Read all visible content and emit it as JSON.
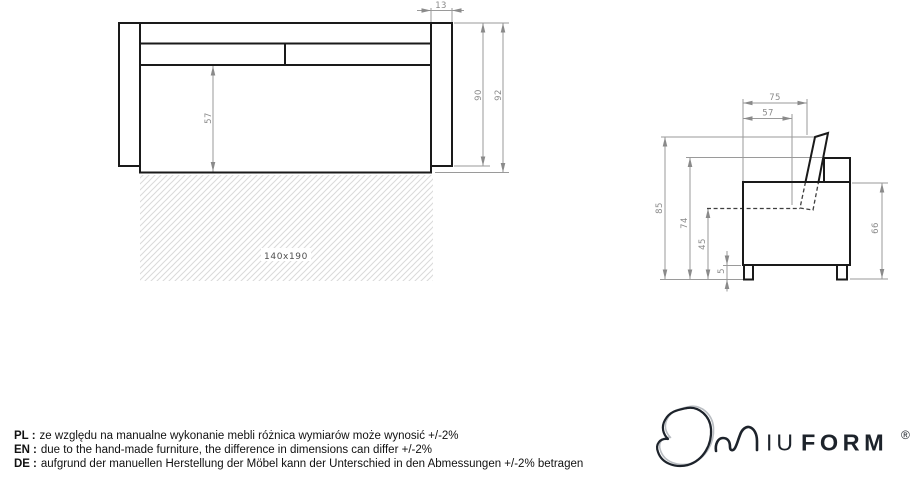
{
  "front_view": {
    "dims": {
      "armrest_width": "13",
      "body_height": "90",
      "total_height": "92",
      "seat_front_height": "57"
    },
    "mattress_label": "140x190"
  },
  "side_view": {
    "dims": {
      "top_depth": "75",
      "seat_depth": "57",
      "cushion_top_height": "85",
      "backrest_height": "74",
      "seat_height": "45",
      "leg_height": "5",
      "body_height": "66"
    }
  },
  "notes": [
    {
      "label": "PL",
      "separator": ":",
      "text": "ze względu na manualne wykonanie mebli różnica wymiarów może wynosić +/-2%"
    },
    {
      "label": "EN",
      "separator": ":",
      "text": "due to the hand-made furniture, the difference in dimensions can differ +/-2%"
    },
    {
      "label": "DE",
      "separator": ":",
      "text": "aufgrund der manuellen Herstellung der Möbel kann der Unterschied in den Abmessungen +/-2% betragen"
    }
  ],
  "logo": {
    "name_light": "IU",
    "name_bold": "FORM",
    "registered": "®"
  },
  "colors": {
    "outline": "#1a1a1a",
    "dimension": "#8a8a8a",
    "hatch": "#d9d9d9",
    "logo": "#1d232b"
  }
}
